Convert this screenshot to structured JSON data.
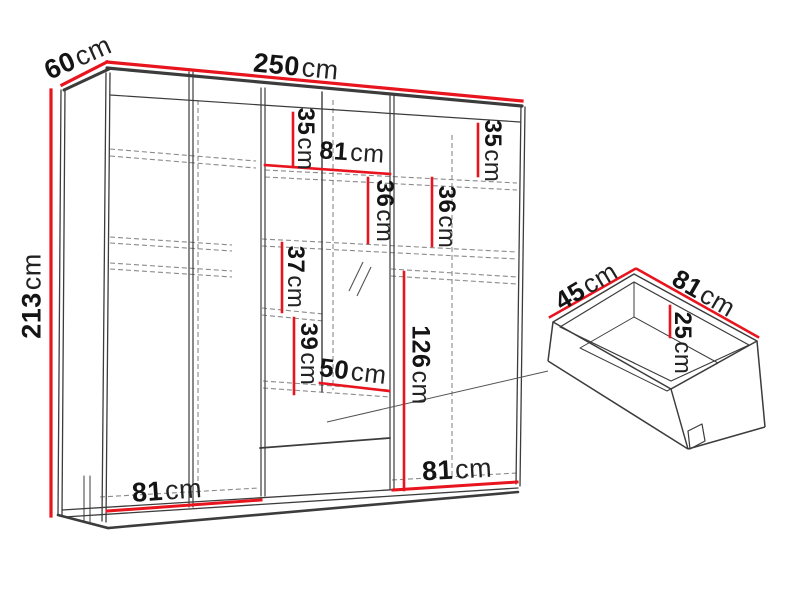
{
  "diagram": {
    "subject": "wardrobe-with-drawer-dimension-diagram",
    "colors": {
      "dimension_line": "#e8141e",
      "outline": "#3c3c3c",
      "hidden_line": "#8a8a8a",
      "text": "#141414",
      "background": "#ffffff"
    }
  },
  "labels": {
    "width250": {
      "value": "250",
      "unit": "cm"
    },
    "depth60": {
      "value": "60",
      "unit": "cm"
    },
    "height213": {
      "value": "213",
      "unit": "cm"
    },
    "midTop35": {
      "value": "35",
      "unit": "cm"
    },
    "midShelf81": {
      "value": "81",
      "unit": "cm"
    },
    "midGap36": {
      "value": "36",
      "unit": "cm"
    },
    "rightTop35": {
      "value": "35",
      "unit": "cm"
    },
    "rightGap36": {
      "value": "36",
      "unit": "cm"
    },
    "midGap37": {
      "value": "37",
      "unit": "cm"
    },
    "midGap39": {
      "value": "39",
      "unit": "cm"
    },
    "drawerZone50": {
      "value": "50",
      "unit": "cm"
    },
    "rightHang126": {
      "value": "126",
      "unit": "cm"
    },
    "bottomLeft81": {
      "value": "81",
      "unit": "cm"
    },
    "bottomRight81": {
      "value": "81",
      "unit": "cm"
    },
    "drawerDepth45": {
      "value": "45",
      "unit": "cm"
    },
    "drawerWidth81": {
      "value": "81",
      "unit": "cm"
    },
    "drawerHeight25": {
      "value": "25",
      "unit": "cm"
    }
  }
}
